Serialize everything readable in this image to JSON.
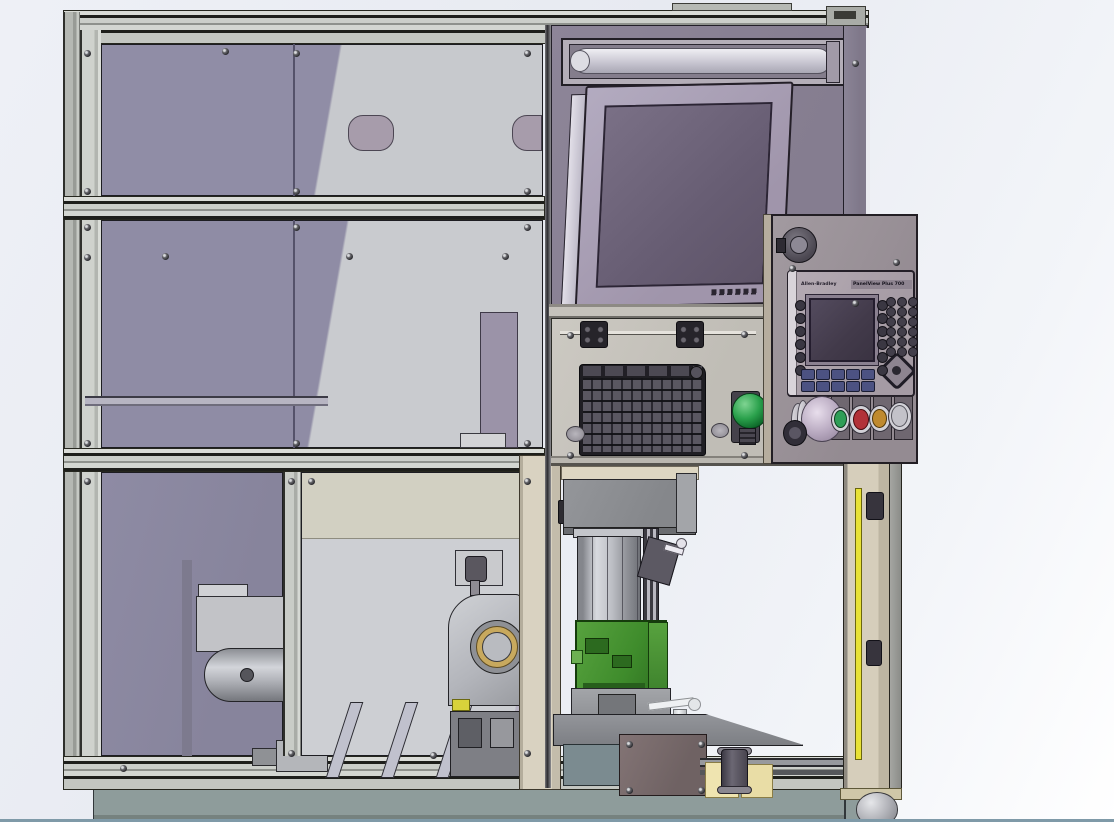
{
  "scene": {
    "medium": "3D CAD render (shaded viewport with gradient background)",
    "subject": "Automated machine cell: aluminum-extrusion safety enclosure with tinted guard windows, overhead light fixture, tilted monitor, fold-down keyboard tray with palm button, Allen-Bradley HMI pendant with pushbuttons, and a part-fixturing station with a green cast workpiece",
    "background_gradient_top": "#edeff5",
    "background_gradient_bottom": "#ffffff",
    "floor_line_color": "#7f9aa8"
  },
  "hmi_pendant": {
    "brand": "Allen-Bradley",
    "model": "PanelView Plus 700",
    "bezel_color": "#aea4ad",
    "screen_color": "#423a4a",
    "pushbutton_colors": {
      "mushroom": "#c3b4ca",
      "green": "#2f9e57",
      "red": "#b23138",
      "amber": "#bf8a2f",
      "silver": "#c3c2c9"
    }
  },
  "operator_station": {
    "palm_button_color": "#1f9e3d",
    "keyboard_color": "#413e45",
    "monitor_screen_color": "#6b6175",
    "light_tube_color": "#d9d8e0"
  },
  "machine": {
    "frame_color": "#c6c9c4",
    "window_tint_color": "#8f8ca6",
    "interior_panel_color": "#c9cbcf",
    "center_post_color": "#d9d2c1",
    "door_post_color": "#d6cebb",
    "light_curtain_color": "#e8e135",
    "workpiece_color": "#4a9336",
    "base_plinth_color": "#8e9c9b",
    "components": [
      "enclosure-frame",
      "guard-windows",
      "interior-motor-assembly",
      "part-chute-ramps",
      "bearing-housing",
      "light-fixture",
      "monitor",
      "keyboard-tray",
      "palm-button",
      "hmi-pendant",
      "pushbutton-row",
      "work-head",
      "lift-cylinder",
      "green-workpiece",
      "fixture-plate",
      "clamp-handle",
      "tool-plate",
      "door-post",
      "light-curtain",
      "leveling-caster"
    ]
  }
}
